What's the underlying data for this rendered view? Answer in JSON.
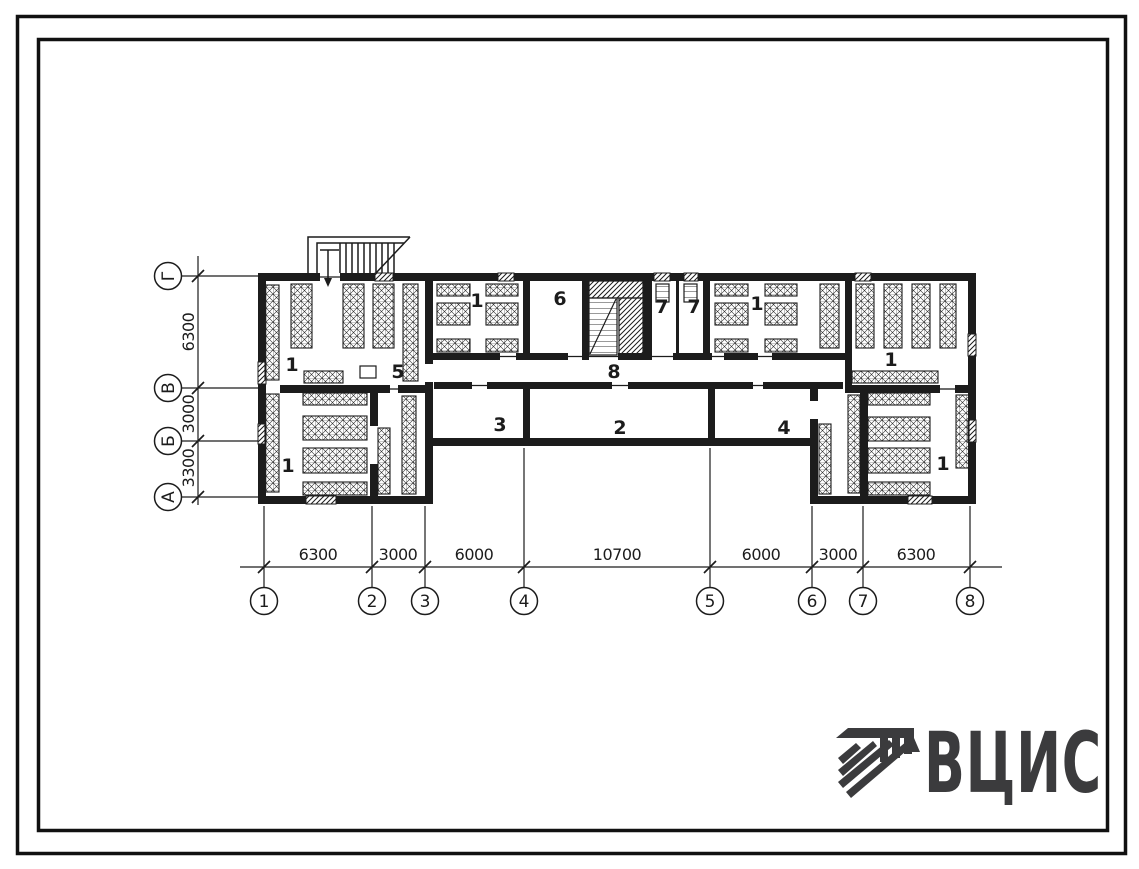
{
  "logo": {
    "text": "ВЦИС"
  },
  "axes": {
    "columns": [
      "1",
      "2",
      "3",
      "4",
      "5",
      "6",
      "7",
      "8"
    ],
    "rows": [
      "Г",
      "В",
      "Б",
      "А"
    ]
  },
  "dimensions": {
    "bottom": [
      "6300",
      "3000",
      "6000",
      "10700",
      "6000",
      "3000",
      "6300"
    ],
    "left": [
      "6300",
      "3000",
      "3300"
    ]
  },
  "rooms": [
    "1",
    "5",
    "1",
    "1",
    "6",
    "8",
    "7",
    "7",
    "1",
    "3",
    "2",
    "4",
    "1",
    "1"
  ],
  "colors": {
    "ink": "#1c1c1c",
    "logo": "#3b3b3d",
    "paper": "#ffffff"
  }
}
